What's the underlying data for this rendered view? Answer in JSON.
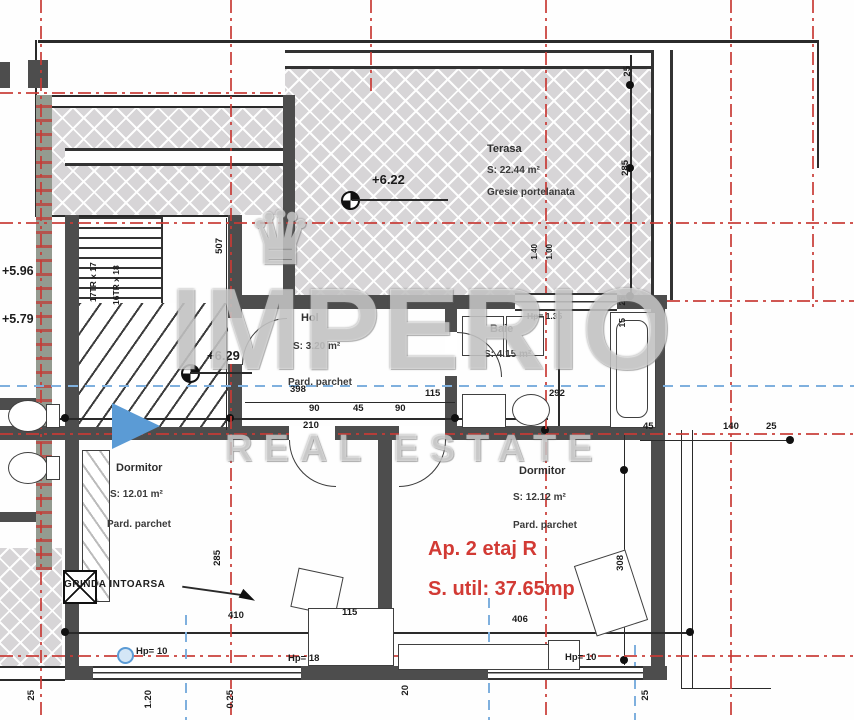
{
  "document": {
    "type": "architectural floor plan"
  },
  "watermark": {
    "brand": "IMPERIO",
    "tagline": "REAL ESTATE",
    "crown_icon": "♛"
  },
  "apartment": {
    "title": "Ap. 2 etaj R",
    "usable_area": "S. util: 37.65mp"
  },
  "rooms": {
    "terasa": {
      "name": "Terasa",
      "area": "S: 22.44 m²",
      "floor": "Gresie portelanata"
    },
    "hol": {
      "name": "Hol",
      "area": "S: 3.20 m²",
      "floor": "Pard. parchet"
    },
    "baie": {
      "name": "Baie",
      "area": "S: 4.15 m²"
    },
    "dormitor_left": {
      "name": "Dormitor",
      "area": "S: 12.01 m²",
      "floor": "Pard. parchet"
    },
    "dormitor_right": {
      "name": "Dormitor",
      "area": "S: 12.12 m²",
      "floor": "Pard. parchet"
    }
  },
  "levels": {
    "terrace": "+6.22",
    "hall": "+6.29",
    "stair_upper": "+5.96",
    "stair_lower": "+5.79"
  },
  "stairs": {
    "flight_a": "17TR x 17",
    "flight_b": "16TR x 18"
  },
  "annotations": {
    "beam": "GRINDA INTOARSA"
  },
  "heights": {
    "baie": "Hp= 1.35",
    "left_window": "Hp= 10",
    "mid_window": "Hp= 18",
    "right_window": "Hp= 10"
  },
  "dims": {
    "terr_h": "285",
    "tr25": "25",
    "stair_v": "507",
    "hol_w": "398",
    "s90a": "90",
    "s45": "45",
    "s90b": "90",
    "s115": "115",
    "s210": "210",
    "baie_w": "292",
    "r45": "45",
    "r140": "140",
    "r25": "25",
    "w25": "25",
    "w15": "15",
    "lbw": "410",
    "rbw": "406",
    "m115": "115",
    "rbh": "308",
    "lbh": "285",
    "sill140": "1.40",
    "sill100": "1.00",
    "b120": "1.20",
    "b025": "0.25",
    "b20": "20",
    "b25a": "25",
    "b25b": "25"
  }
}
